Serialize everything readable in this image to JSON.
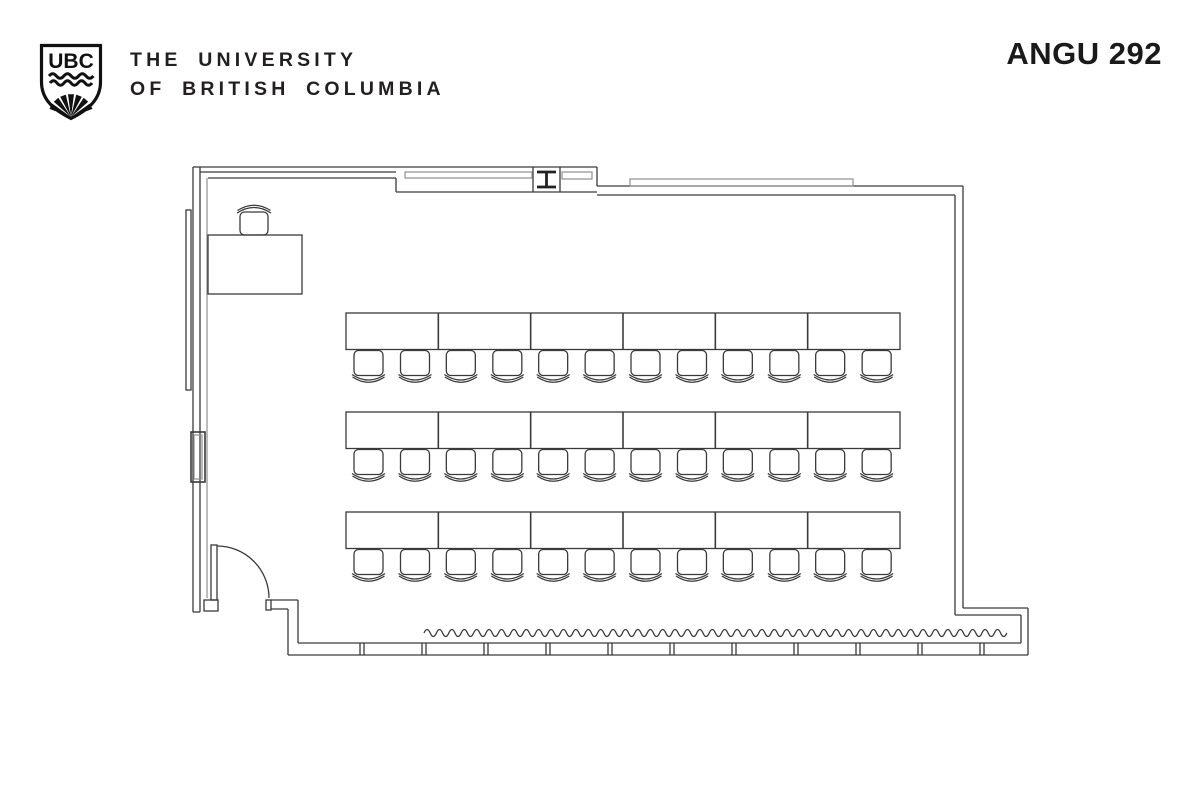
{
  "header": {
    "logo_text": "UBC",
    "university_line1": "THE UNIVERSITY",
    "university_line2": "OF BRITISH COLUMBIA",
    "room_label": "ANGU 292"
  },
  "colors": {
    "line": "#3a3a3a",
    "line_light": "#8f8f8f",
    "text": "#231f20",
    "background": "#ffffff"
  },
  "floor_plan": {
    "type": "classroom-seating-plan",
    "room": "ANGU 292",
    "seating": {
      "rows": 3,
      "tables_per_row": 6,
      "chairs_per_table": 2,
      "total_chairs": 36,
      "row_y": [
        313,
        412,
        512
      ],
      "tables_x": 346,
      "tables_total_width": 554,
      "table_height": 36.5,
      "chair_center_offsets": [
        22.5,
        69
      ]
    },
    "instructor": {
      "desk": {
        "x": 208,
        "y": 235,
        "width": 94,
        "height": 59
      },
      "chair_cx": 254,
      "chair_y": 235
    },
    "window_wall": {
      "squiggle_x_start": 424,
      "squiggle_x_end": 1019,
      "squiggle_y": 633,
      "sill_dividers_x_start": 360,
      "sill_divider_spacing": 62,
      "sill_divider_count": 11
    },
    "features": {
      "door": "swing-door-bottom-left",
      "column": "steel-column-top-wall",
      "whiteboard": "left-wall-panel",
      "windows": "bottom-window-wall"
    }
  }
}
